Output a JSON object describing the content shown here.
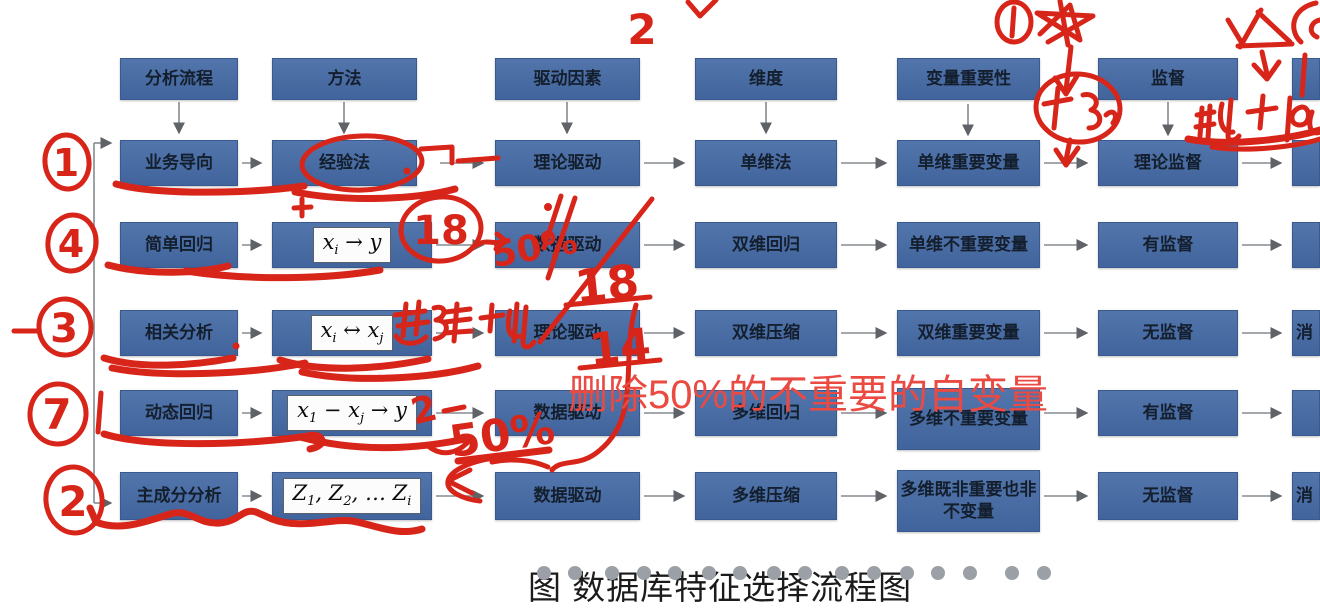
{
  "flow": {
    "headers": [
      "分析流程",
      "方法",
      "驱动因素",
      "维度",
      "变量重要性",
      "监督"
    ],
    "col1": [
      "业务导向",
      "简单回归",
      "相关分析",
      "动态回归",
      "主成分分析"
    ],
    "col2_row1": "经验法",
    "formulas": {
      "r2": [
        "x",
        "i",
        " → y"
      ],
      "r3": [
        "x",
        "i",
        " ↔ x",
        "j"
      ],
      "r4": [
        "x",
        "1",
        " − x",
        "j",
        " → y"
      ],
      "r5": [
        "Z",
        "1",
        ", Z",
        "2",
        ", … Z",
        "i"
      ]
    },
    "col3": [
      "理论驱动",
      "数据驱动",
      "理论驱动",
      "数据驱动",
      "数据驱动"
    ],
    "col4": [
      "单维法",
      "双维回归",
      "双维压缩",
      "多维回归",
      "多维压缩"
    ],
    "col5": [
      "单维重要变量",
      "单维不重要变量",
      "双维重要变量",
      "多维不重要变量",
      "多维既非重要也非不变量"
    ],
    "col6": [
      "理论监督",
      "有监督",
      "无监督",
      "有监督",
      "无监督"
    ],
    "col7": [
      "",
      "",
      "消",
      "",
      "消"
    ]
  },
  "caption": {
    "text": "图  数据库特征选择流程图",
    "dots_count": 16
  },
  "annotations": {
    "ink_color": "#d8251a",
    "typed_overlay": "删除50%的不重要的自变量",
    "left_sequence_marks": [
      "1",
      "4",
      "3",
      "7",
      "2"
    ],
    "top_mark": "2",
    "circled_value": "18",
    "value_18": "18",
    "value_14": "14",
    "pct_row2": "50%",
    "pct_row4": "50%",
    "row4_mark": "2"
  }
}
